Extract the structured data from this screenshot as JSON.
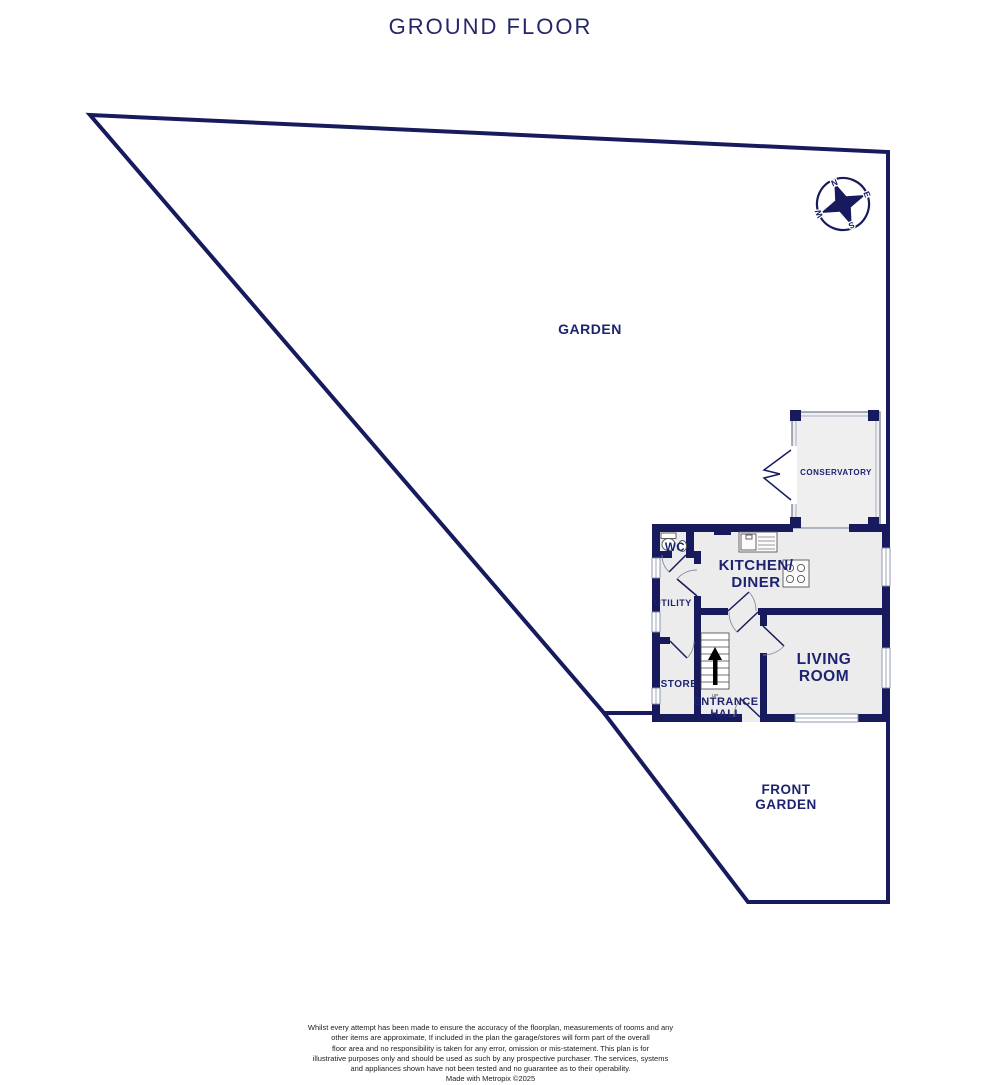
{
  "title": "GROUND FLOOR",
  "labels": {
    "garden": "GARDEN",
    "front_garden": [
      "FRONT",
      "GARDEN"
    ],
    "conservatory": "CONSERVATORY",
    "wc": "WC",
    "kitchen_diner": [
      "KITCHEN/",
      "DINER"
    ],
    "utility": "UTILITY",
    "store": "STORE",
    "entrance_hall": [
      "ENTRANCE",
      "HALL"
    ],
    "living_room": [
      "LIVING",
      "ROOM"
    ],
    "stairs_direction": "UP"
  },
  "compass": {
    "north": "N",
    "east": "E",
    "south": "S",
    "west": "W"
  },
  "colors": {
    "wall_navy": "#171b5e",
    "label_navy": "#1d2370",
    "title_navy": "#23266a",
    "room_fill": "#ececec"
  },
  "footer": {
    "lines": [
      "Whilst every attempt has been made to ensure the accuracy of the floorplan, measurements of rooms and any",
      "other items are approximate, If included in the plan the garage/stores will form part of the overall",
      "floor area and no responsibility is taken for any error, omission or mis-statement. This plan is for",
      "illustrative purposes only and should be used as such by any prospective purchaser. The services, systems",
      "and appliances shown have not been tested and no guarantee as to their operability."
    ],
    "credit": "Made with Metropix ©2025"
  }
}
